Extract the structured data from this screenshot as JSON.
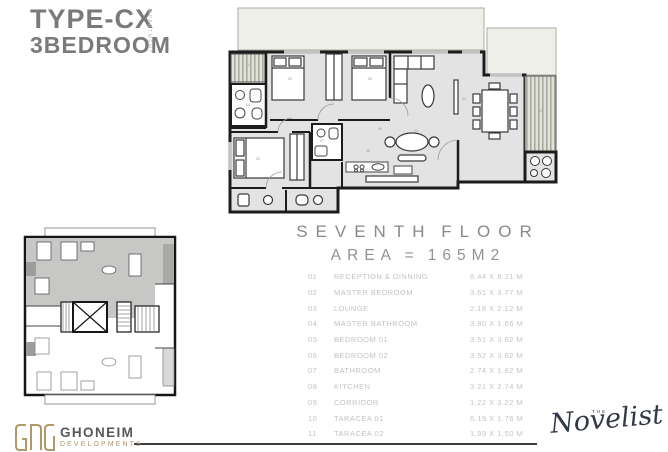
{
  "title": {
    "line1": "TYPE-CX",
    "line2": "3BEDROOM",
    "vertical_label": "APARTMENT"
  },
  "heading": {
    "floor_label": "SEVENTH FLOOR",
    "area_label": "AREA = 165M2"
  },
  "rooms": [
    {
      "num": "01",
      "name": "RECEPTION & DINNING",
      "dims": "6.44 X 8.21 M"
    },
    {
      "num": "02",
      "name": "MASTER BEDROOM",
      "dims": "3.61 X 3.77 M"
    },
    {
      "num": "03",
      "name": "LOUNGE",
      "dims": "2.18 X 2.12 M"
    },
    {
      "num": "04",
      "name": "MASTER BATHROOM",
      "dims": "3.80 X 1.66 M"
    },
    {
      "num": "05",
      "name": "BEDROOM  01",
      "dims": "3.51 X 3.62 M"
    },
    {
      "num": "06",
      "name": "BEDROOM  02",
      "dims": "3.52 X 3.62 M"
    },
    {
      "num": "07",
      "name": "BATHROOM",
      "dims": "2.74 X 1.82 M"
    },
    {
      "num": "08",
      "name": "KITCHEN",
      "dims": "3.21 X 2.74 M"
    },
    {
      "num": "09",
      "name": "CORRIDOR",
      "dims": "1.22 X 3.22 M"
    },
    {
      "num": "10",
      "name": "TARACEA 01",
      "dims": "6.19 X 1.76 M"
    },
    {
      "num": "11",
      "name": "TARACEA 02",
      "dims": "1.99 X 1.50 M"
    }
  ],
  "footer": {
    "brand_name": "GHONEIM",
    "brand_sub": "DEVELOPMENTS",
    "logo_icon": "ghoneim-monogram-icon",
    "right_logo_small": "THE",
    "right_logo_text": "Novelist"
  },
  "colors": {
    "title_gray": "#7a7a7a",
    "heading_gray": "#88898b",
    "table_text": "#c3c3c5",
    "plan_wall": "#1c1c1c",
    "plan_floor": "#e3e3e3",
    "terrace_fill": "#edefe8",
    "keyplan_highlight": "#c7c7c5",
    "accent_gold": "#b2976a",
    "novelist_navy": "#323947",
    "rule_dark": "#3c3c3c"
  }
}
